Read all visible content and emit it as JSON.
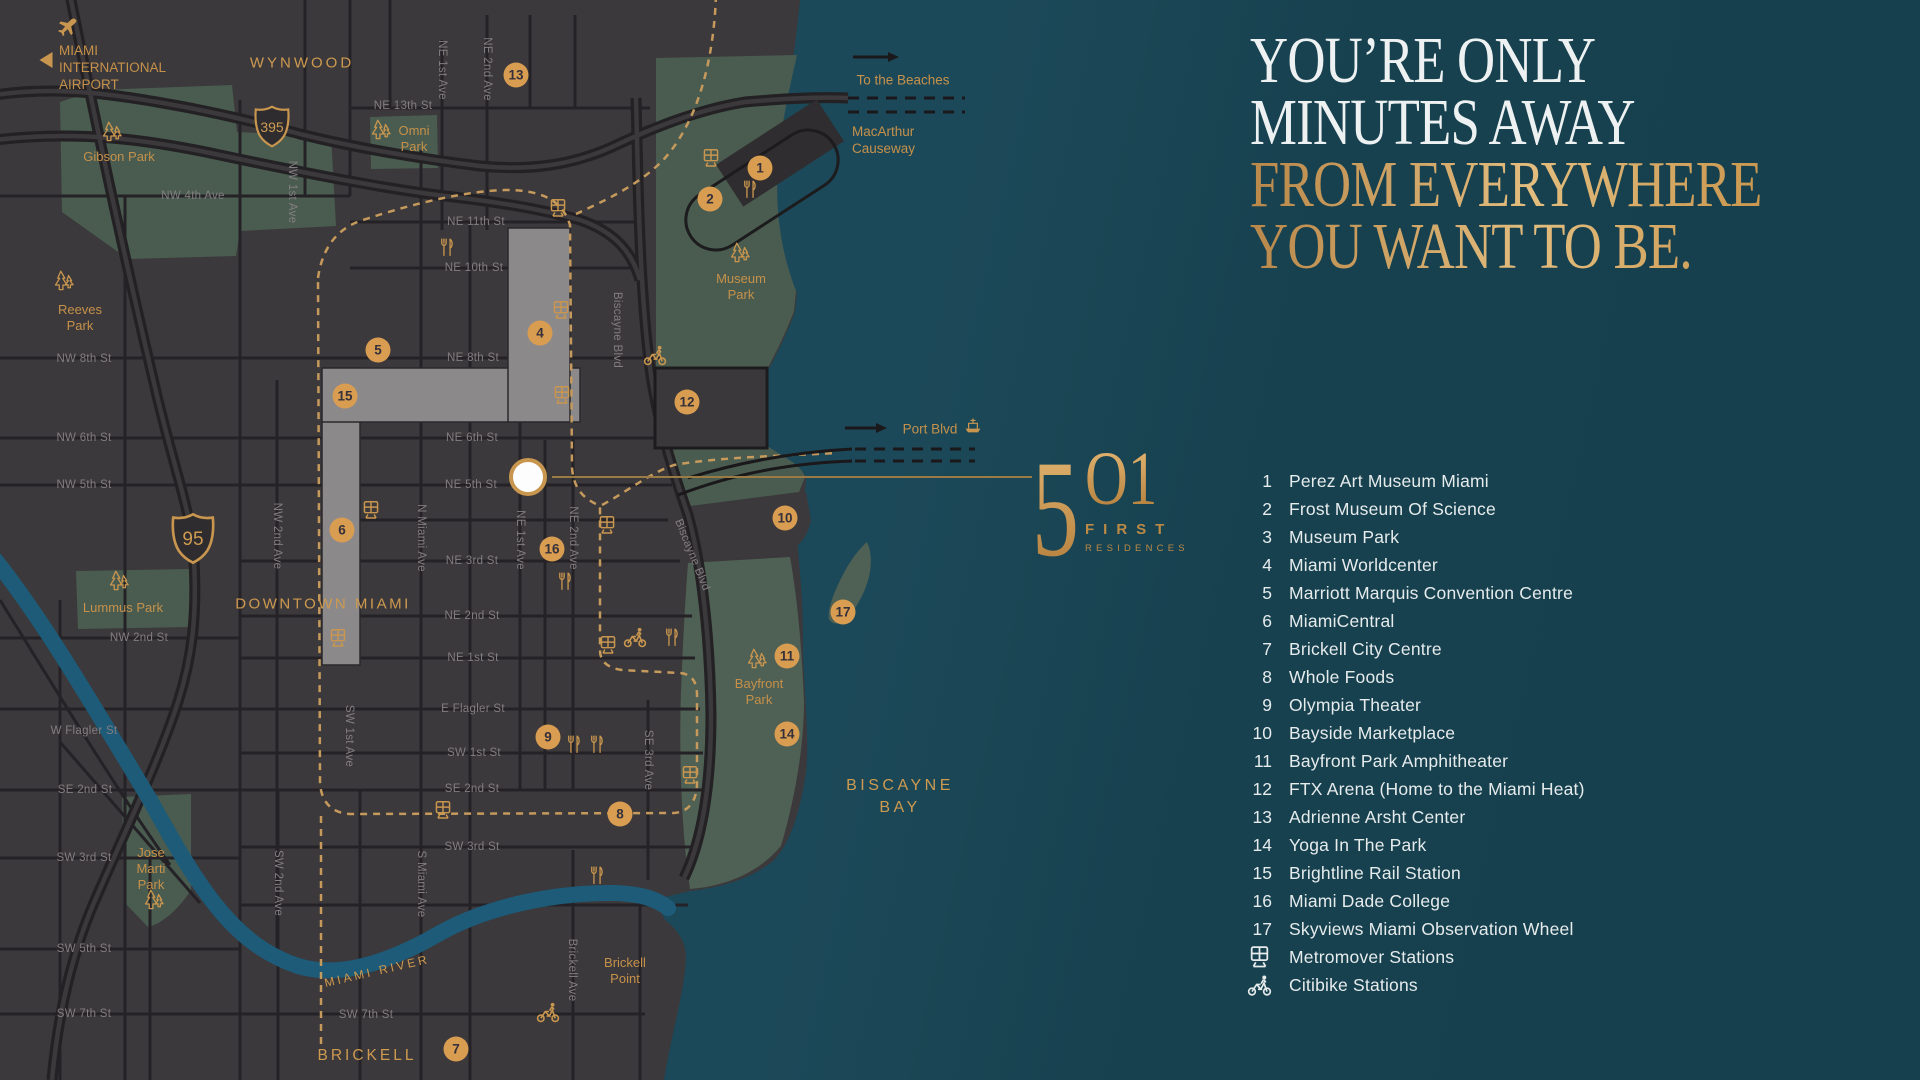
{
  "colors": {
    "gold": "#c9964f",
    "marker_fill": "#d99d52",
    "panel_bg": "#16404e",
    "land": "#3b393b",
    "park_green": "#4a5c50",
    "water": "#1c4959",
    "river": "#1d5b78",
    "white_text": "#edf1f2"
  },
  "right_panel": {
    "title_lines": [
      {
        "t": "YOU’RE ONLY",
        "c": "white"
      },
      {
        "t": "MINUTES AWAY",
        "c": "white"
      },
      {
        "t": "FROM EVERYWHERE",
        "c": "gold"
      },
      {
        "t": "YOU WANT TO BE.",
        "c": "gold"
      }
    ],
    "logo": {
      "n1": "5",
      "n2": "O1",
      "sub1": "FIRST",
      "sub2": "RESIDENCES"
    },
    "legend": [
      {
        "n": "1",
        "t": "Perez Art Museum Miami"
      },
      {
        "n": "2",
        "t": "Frost Museum Of Science"
      },
      {
        "n": "3",
        "t": "Museum Park"
      },
      {
        "n": "4",
        "t": "Miami Worldcenter"
      },
      {
        "n": "5",
        "t": "Marriott Marquis Convention Centre"
      },
      {
        "n": "6",
        "t": "MiamiCentral"
      },
      {
        "n": "7",
        "t": "Brickell City Centre"
      },
      {
        "n": "8",
        "t": "Whole Foods"
      },
      {
        "n": "9",
        "t": "Olympia Theater"
      },
      {
        "n": "10",
        "t": "Bayside Marketplace"
      },
      {
        "n": "11",
        "t": "Bayfront Park Amphitheater"
      },
      {
        "n": "12",
        "t": "FTX Arena (Home to the Miami Heat)"
      },
      {
        "n": "13",
        "t": "Adrienne Arsht Center"
      },
      {
        "n": "14",
        "t": "Yoga In The Park"
      },
      {
        "n": "15",
        "t": "Brightline Rail Station"
      },
      {
        "n": "16",
        "t": "Miami Dade College"
      },
      {
        "n": "17",
        "t": "Skyviews Miami Observation Wheel"
      },
      {
        "icon": "train",
        "t": "Metromover Stations"
      },
      {
        "icon": "bike",
        "t": "Citibike Stations"
      }
    ]
  },
  "map": {
    "area_labels": [
      {
        "t": "WYNWOOD",
        "x": 302,
        "y": 63,
        "fs": 15,
        "ls": 3
      },
      {
        "t": "DOWNTOWN MIAMI",
        "x": 323,
        "y": 604,
        "fs": 15,
        "ls": 2.5
      },
      {
        "t": "BRICKELL",
        "x": 367,
        "y": 1056,
        "fs": 15.5,
        "ls": 3
      },
      {
        "t": "BISCAYNE",
        "x": 900,
        "y": 786,
        "fs": 16,
        "ls": 3.5
      },
      {
        "t": "BAY",
        "x": 900,
        "y": 808,
        "fs": 16,
        "ls": 3.5
      },
      {
        "t": "MIAMI RIVER",
        "x": 377,
        "y": 971,
        "fs": 12,
        "ls": 3,
        "r": -13
      }
    ],
    "street_labels": [
      {
        "t": "NE 13th St",
        "x": 403,
        "y": 106
      },
      {
        "t": "NW 4th Ave",
        "x": 193,
        "y": 196
      },
      {
        "t": "NE 11th St",
        "x": 476,
        "y": 222
      },
      {
        "t": "NE 10th St",
        "x": 474,
        "y": 268
      },
      {
        "t": "NW 8th St",
        "x": 84,
        "y": 359
      },
      {
        "t": "NE 8th St",
        "x": 473,
        "y": 358
      },
      {
        "t": "NW 6th St",
        "x": 84,
        "y": 438
      },
      {
        "t": "NE 6th St",
        "x": 472,
        "y": 438
      },
      {
        "t": "NW 5th St",
        "x": 84,
        "y": 485
      },
      {
        "t": "NE 5th St",
        "x": 471,
        "y": 485
      },
      {
        "t": "NE 3rd St",
        "x": 472,
        "y": 561
      },
      {
        "t": "NE 2nd St",
        "x": 472,
        "y": 616
      },
      {
        "t": "NW 2nd St",
        "x": 139,
        "y": 638
      },
      {
        "t": "NE 1st St",
        "x": 473,
        "y": 658
      },
      {
        "t": "E Flagler St",
        "x": 473,
        "y": 709
      },
      {
        "t": "W Flagler St",
        "x": 84,
        "y": 731
      },
      {
        "t": "SW 1st St",
        "x": 474,
        "y": 753
      },
      {
        "t": "SE 2nd St",
        "x": 85,
        "y": 790
      },
      {
        "t": "SE 2nd St",
        "x": 472,
        "y": 789
      },
      {
        "t": "SW 3rd St",
        "x": 84,
        "y": 858
      },
      {
        "t": "SW 3rd St",
        "x": 472,
        "y": 847
      },
      {
        "t": "SW 5th St",
        "x": 84,
        "y": 949
      },
      {
        "t": "SW 7th St",
        "x": 84,
        "y": 1014
      },
      {
        "t": "SW 7th St",
        "x": 366,
        "y": 1015
      },
      {
        "t": "NE 1st Ave",
        "x": 442,
        "y": 70,
        "r": 90
      },
      {
        "t": "NE 2nd Ave",
        "x": 487,
        "y": 69,
        "r": 90
      },
      {
        "t": "NW 1st Ave",
        "x": 292,
        "y": 192,
        "r": 90
      },
      {
        "t": "Biscayne Blvd",
        "x": 617,
        "y": 330,
        "r": 90
      },
      {
        "t": "NW 2nd Ave",
        "x": 277,
        "y": 536,
        "r": 90
      },
      {
        "t": "N Miami Ave",
        "x": 421,
        "y": 538,
        "r": 90
      },
      {
        "t": "NE 1st Ave",
        "x": 520,
        "y": 540,
        "r": 90
      },
      {
        "t": "NE 2nd Ave",
        "x": 573,
        "y": 538,
        "r": 90
      },
      {
        "t": "Biscayne Blvd",
        "x": 692,
        "y": 555,
        "r": 68
      },
      {
        "t": "SW 1st Ave",
        "x": 349,
        "y": 736,
        "r": 90
      },
      {
        "t": "SE 3rd Ave",
        "x": 648,
        "y": 760,
        "r": 90
      },
      {
        "t": "SW 2nd Ave",
        "x": 278,
        "y": 883,
        "r": 90
      },
      {
        "t": "S Miami Ave",
        "x": 421,
        "y": 884,
        "r": 90
      },
      {
        "t": "Brickell Ave",
        "x": 572,
        "y": 970,
        "r": 90
      }
    ],
    "park_labels": [
      {
        "lines": [
          "Gibson Park"
        ],
        "x": 119,
        "y": 157,
        "tx": 112,
        "ty": 135
      },
      {
        "lines": [
          "Omni",
          "Park"
        ],
        "x": 414,
        "y": 139,
        "tx": 381,
        "ty": 133
      },
      {
        "lines": [
          "Reeves",
          "Park"
        ],
        "x": 80,
        "y": 318,
        "tx": 64,
        "ty": 284
      },
      {
        "lines": [
          "Museum",
          "Park"
        ],
        "x": 741,
        "y": 287,
        "tx": 740,
        "ty": 256
      },
      {
        "lines": [
          "Lummus Park"
        ],
        "x": 123,
        "y": 608,
        "tx": 119,
        "ty": 584
      },
      {
        "lines": [
          "Bayfront",
          "Park"
        ],
        "x": 759,
        "y": 692,
        "tx": 757,
        "ty": 662
      },
      {
        "lines": [
          "Jose",
          "Marti",
          "Park"
        ],
        "x": 151,
        "y": 869,
        "tx": 154,
        "ty": 903
      },
      {
        "lines": [
          "Brickell",
          "Point"
        ],
        "x": 625,
        "y": 971
      }
    ],
    "markers": [
      {
        "n": "1",
        "x": 760,
        "y": 168
      },
      {
        "n": "2",
        "x": 710,
        "y": 199
      },
      {
        "n": "4",
        "x": 540,
        "y": 333
      },
      {
        "n": "5",
        "x": 378,
        "y": 350
      },
      {
        "n": "6",
        "x": 342,
        "y": 530
      },
      {
        "n": "7",
        "x": 456,
        "y": 1049
      },
      {
        "n": "8",
        "x": 620,
        "y": 814
      },
      {
        "n": "9",
        "x": 548,
        "y": 737
      },
      {
        "n": "10",
        "x": 785,
        "y": 518
      },
      {
        "n": "11",
        "x": 787,
        "y": 656
      },
      {
        "n": "12",
        "x": 687,
        "y": 402
      },
      {
        "n": "13",
        "x": 516,
        "y": 75
      },
      {
        "n": "14",
        "x": 787,
        "y": 734
      },
      {
        "n": "15",
        "x": 345,
        "y": 396
      },
      {
        "n": "16",
        "x": 552,
        "y": 549
      },
      {
        "n": "17",
        "x": 843,
        "y": 612
      }
    ],
    "icons": [
      {
        "k": "plane",
        "x": 67,
        "y": 31
      },
      {
        "k": "train",
        "x": 711,
        "y": 161
      },
      {
        "k": "train",
        "x": 558,
        "y": 211
      },
      {
        "k": "train",
        "x": 561,
        "y": 313
      },
      {
        "k": "train",
        "x": 562,
        "y": 398
      },
      {
        "k": "train",
        "x": 607,
        "y": 528
      },
      {
        "k": "train",
        "x": 371,
        "y": 513
      },
      {
        "k": "train",
        "x": 338,
        "y": 641
      },
      {
        "k": "train",
        "x": 608,
        "y": 648
      },
      {
        "k": "train",
        "x": 690,
        "y": 778
      },
      {
        "k": "train",
        "x": 443,
        "y": 813
      },
      {
        "k": "food",
        "x": 750,
        "y": 192
      },
      {
        "k": "food",
        "x": 447,
        "y": 250
      },
      {
        "k": "food",
        "x": 565,
        "y": 584
      },
      {
        "k": "food",
        "x": 672,
        "y": 640
      },
      {
        "k": "food",
        "x": 574,
        "y": 747
      },
      {
        "k": "food",
        "x": 597,
        "y": 747
      },
      {
        "k": "food",
        "x": 597,
        "y": 878
      },
      {
        "k": "bike",
        "x": 655,
        "y": 358
      },
      {
        "k": "bike",
        "x": 635,
        "y": 640
      },
      {
        "k": "bike",
        "x": 548,
        "y": 1015
      },
      {
        "k": "ship",
        "x": 973,
        "y": 428
      }
    ],
    "shields": [
      {
        "n": "395",
        "x": 272,
        "y": 129,
        "w": 36,
        "h": 44,
        "fs": 14
      },
      {
        "n": "95",
        "x": 193,
        "y": 541,
        "w": 44,
        "h": 52,
        "fs": 19
      }
    ],
    "directions": [
      {
        "lines": [
          "To the Beaches"
        ],
        "x": 903,
        "y": 80,
        "align": "center"
      },
      {
        "lines": [
          "MacArthur",
          "Causeway"
        ],
        "x": 852,
        "y": 140,
        "align": "left"
      },
      {
        "lines": [
          "Port Blvd"
        ],
        "x": 930,
        "y": 429,
        "align": "center"
      }
    ],
    "airport": {
      "lines": [
        "MIAMI",
        "INTERNATIONAL",
        "AIRPORT"
      ],
      "x": 59,
      "y": 42
    }
  }
}
